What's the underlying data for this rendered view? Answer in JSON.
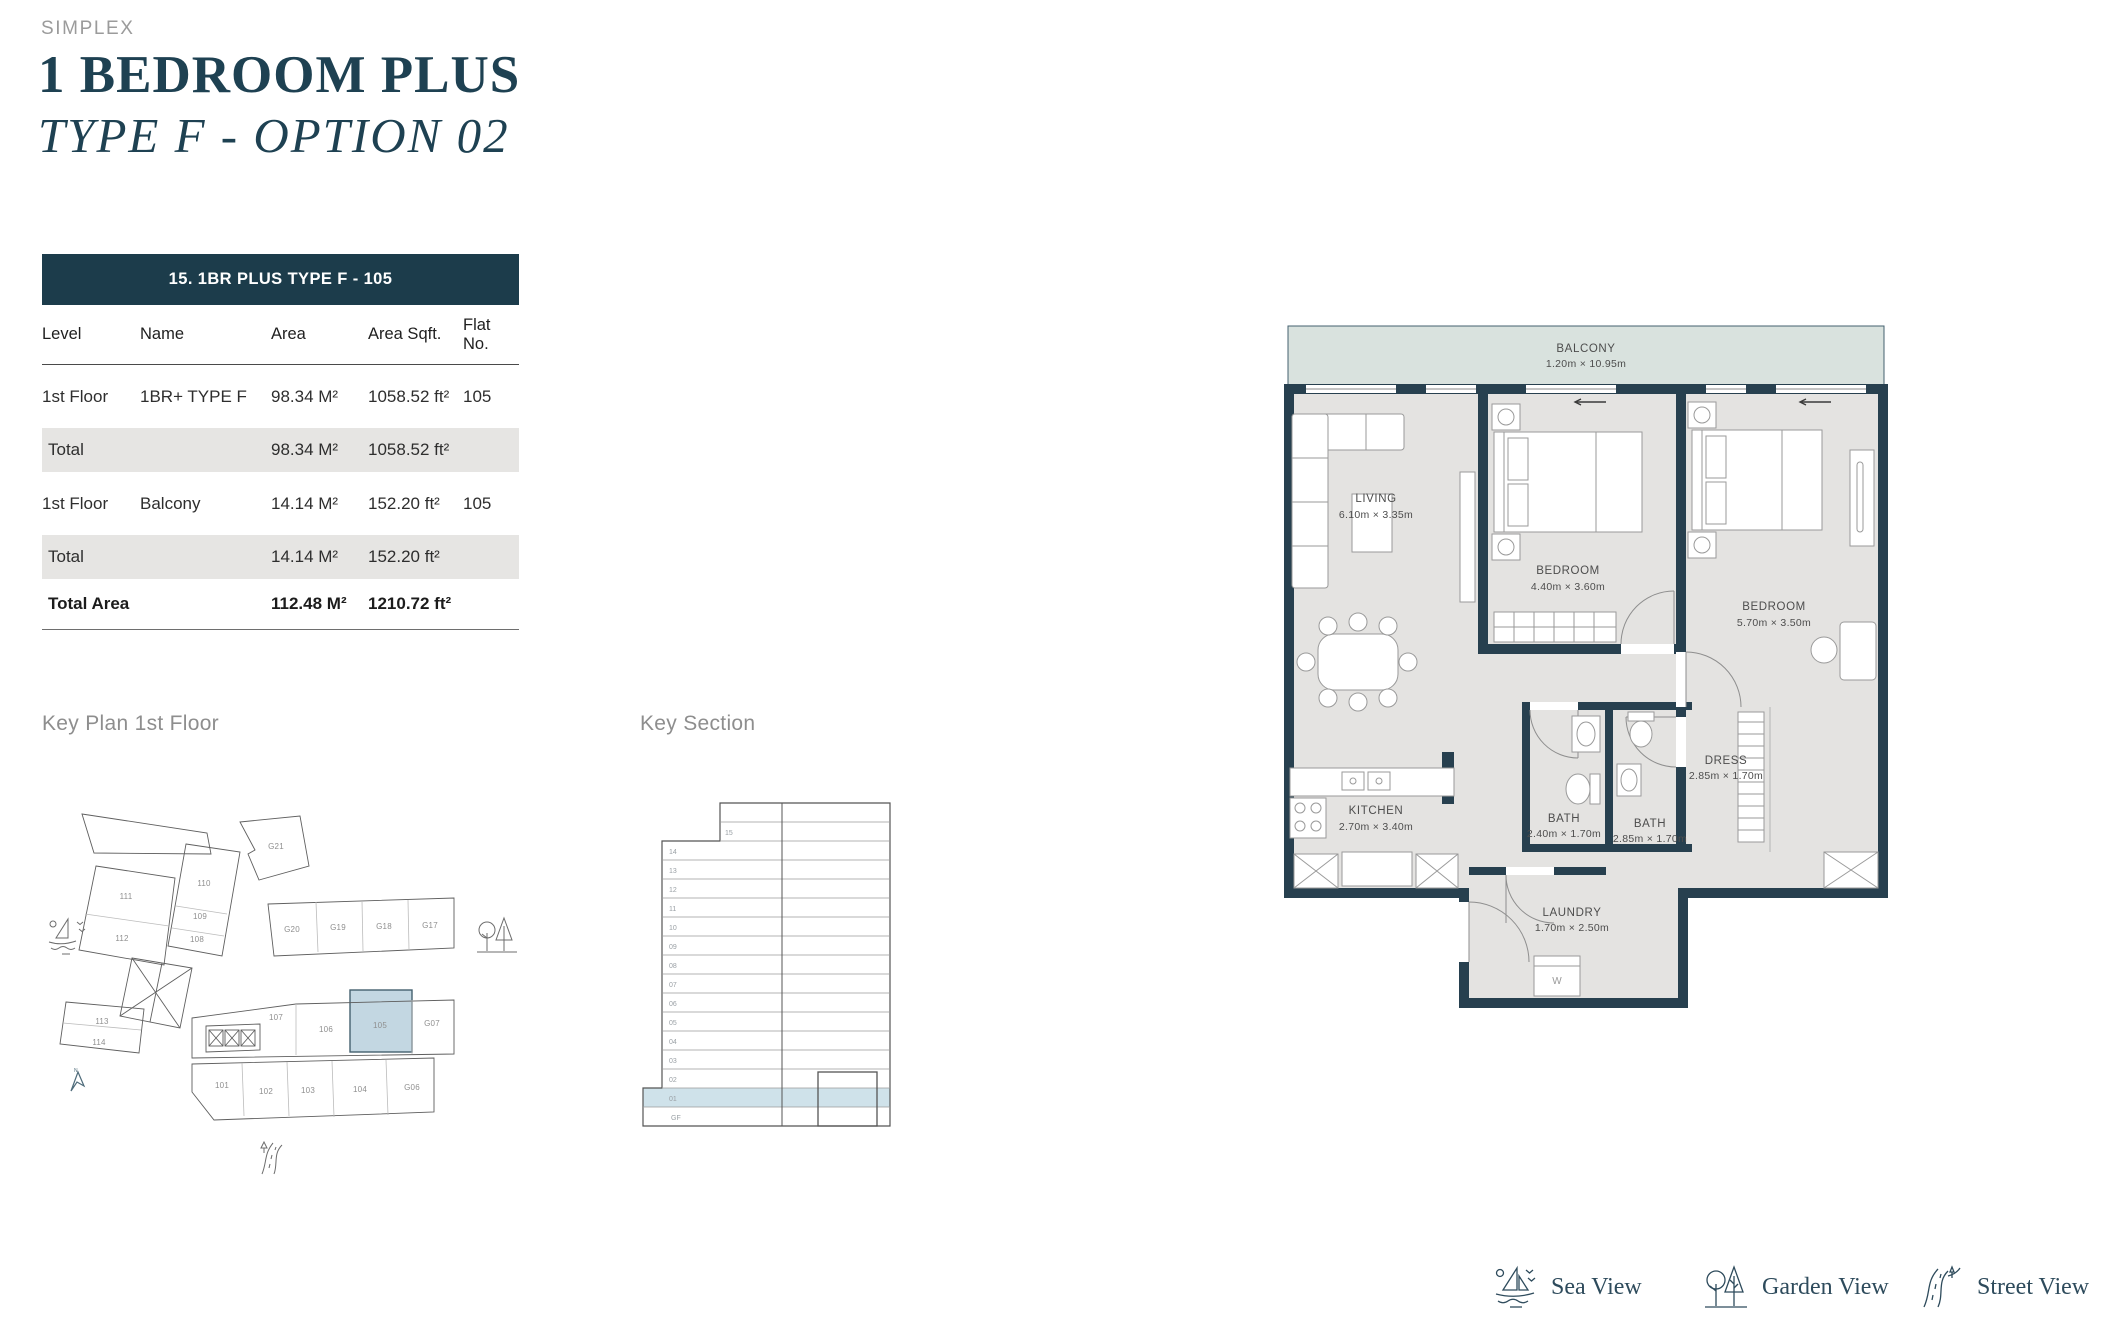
{
  "page": {
    "brand": "SIMPLEX",
    "title": "1 BEDROOM PLUS",
    "subtitle": "TYPE F - OPTION 02"
  },
  "table": {
    "header_title": "15. 1BR PLUS TYPE F - 105",
    "columns": [
      "Level",
      "Name",
      "Area",
      "Area Sqft.",
      "Flat No."
    ],
    "rows": [
      {
        "level": "1st Floor",
        "name": "1BR+ TYPE F",
        "area": "98.34 M²",
        "area_sqft": "1058.52 ft²",
        "flat": "105"
      },
      {
        "level": "Total",
        "name": "",
        "area": "98.34 M²",
        "area_sqft": "1058.52 ft²",
        "flat": ""
      },
      {
        "level": "1st Floor",
        "name": "Balcony",
        "area": "14.14 M²",
        "area_sqft": "152.20 ft²",
        "flat": "105"
      },
      {
        "level": "Total",
        "name": "",
        "area": "14.14 M²",
        "area_sqft": "152.20 ft²",
        "flat": ""
      },
      {
        "level": "Total Area",
        "name": "",
        "area": "112.48 M²",
        "area_sqft": "1210.72 ft²",
        "flat": ""
      }
    ]
  },
  "key_plan": {
    "title": "Key Plan 1st Floor",
    "highlighted_unit": "105",
    "units": [
      "111",
      "112",
      "110",
      "109",
      "108",
      "G21",
      "G20",
      "G19",
      "G18",
      "G17",
      "113",
      "114",
      "107",
      "106",
      "105",
      "G07",
      "101",
      "102",
      "103",
      "104",
      "G06"
    ]
  },
  "key_section": {
    "title": "Key Section",
    "highlighted_floor": "01",
    "floors": [
      "15",
      "14",
      "13",
      "12",
      "11",
      "10",
      "09",
      "08",
      "07",
      "06",
      "05",
      "04",
      "03",
      "02",
      "01",
      "GF"
    ]
  },
  "floor_plan": {
    "rooms": {
      "balcony": {
        "name": "BALCONY",
        "dims": "1.20m × 10.95m"
      },
      "living": {
        "name": "LIVING",
        "dims": "6.10m × 3.35m"
      },
      "bedroom1": {
        "name": "BEDROOM",
        "dims": "4.40m × 3.60m"
      },
      "bedroom2": {
        "name": "BEDROOM",
        "dims": "5.70m × 3.50m"
      },
      "kitchen": {
        "name": "KITCHEN",
        "dims": "2.70m × 3.40m"
      },
      "bath1": {
        "name": "BATH",
        "dims": "2.40m × 1.70m"
      },
      "bath2": {
        "name": "BATH",
        "dims": "2.85m × 1.70m"
      },
      "dress": {
        "name": "DRESS",
        "dims": "2.85m × 1.70m"
      },
      "laundry": {
        "name": "LAUNDRY",
        "dims": "1.70m × 2.50m"
      }
    },
    "washer_label": "W"
  },
  "legend": {
    "items": [
      {
        "label": "Sea View"
      },
      {
        "label": "Garden View"
      },
      {
        "label": "Street View"
      }
    ]
  },
  "colors": {
    "accent_dark": "#1e4152",
    "table_header_bg": "#1c3c4b",
    "total_row_bg": "#e6e5e3",
    "wall": "#27404f",
    "floor_fill": "#e4e3e1",
    "balcony_fill": "#d9e2de",
    "unit_highlight": "#c3d7e2",
    "section_highlight": "#cfe2ea"
  }
}
